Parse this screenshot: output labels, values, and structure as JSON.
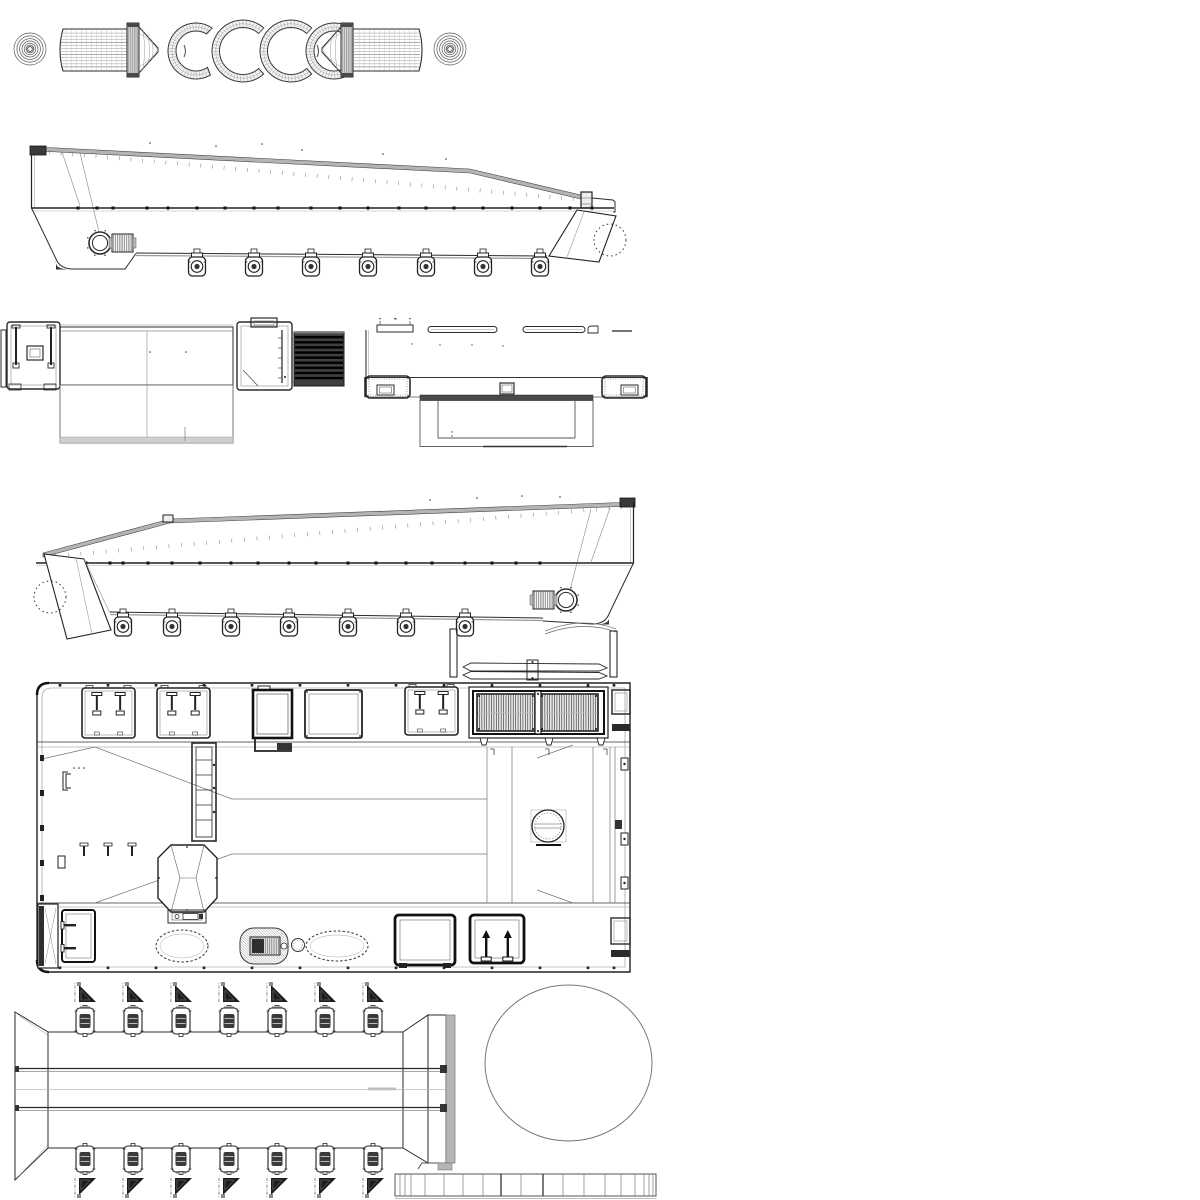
{
  "canvas": {
    "width": 1200,
    "height": 1200,
    "background": "#ffffff"
  },
  "palette": {
    "ink": "#2b2b2b",
    "ink_mid": "#555555",
    "ink_light": "#8a8a8a",
    "ink_faint": "#bdbdbd",
    "fill_dark": "#3a3a3a",
    "fill_black": "#0d0d0d",
    "deck_gray": "#b4b4b4",
    "strip_gray": "#cfcfcf",
    "paper": "#ffffff"
  },
  "drawing": {
    "title": "Landing craft hull - multi-view wireframe blueprint",
    "views": [
      {
        "id": "parts-strip",
        "label": "roller drums, end discs and fender arc segments"
      },
      {
        "id": "side-view-starboard",
        "label": "hull side elevation, bow right"
      },
      {
        "id": "end-view-bow",
        "label": "end elevation with louver block"
      },
      {
        "id": "end-view-stern",
        "label": "end elevation with outrigger pods"
      },
      {
        "id": "side-view-port",
        "label": "hull side elevation, bow left"
      },
      {
        "id": "deck-plan",
        "label": "deck plan with hatches and engine grilles"
      },
      {
        "id": "ramp-flat",
        "label": "ramp flat pattern with roller fittings"
      },
      {
        "id": "disc-part",
        "label": "large circular part"
      },
      {
        "id": "segment-strip",
        "label": "segmented edge band"
      }
    ]
  },
  "parts_strip": {
    "discs": [
      {
        "cx": 30,
        "cy": 49,
        "r": 16
      },
      {
        "cx": 450,
        "cy": 49,
        "r": 16
      }
    ],
    "arcs": [
      {
        "cx": 196,
        "cy": 51,
        "R": 28,
        "r": 20,
        "a0": 55,
        "a1": 305
      },
      {
        "cx": 243,
        "cy": 51,
        "R": 31,
        "r": 23.5,
        "a0": 48,
        "a1": 312
      },
      {
        "cx": 291,
        "cy": 51,
        "R": 31,
        "r": 23.5,
        "a0": 48,
        "a1": 312
      },
      {
        "cx": 334,
        "cy": 51,
        "R": 28,
        "r": 20,
        "a0": 55,
        "a1": 305
      }
    ],
    "hatch_step_deg": 7,
    "mesh_rows": 13,
    "mesh_cols": 13
  },
  "side_starboard": {
    "keel_y": 254,
    "roller_xs": [
      197,
      254,
      311,
      368,
      426,
      483,
      540
    ],
    "gunwale_y": 208,
    "gunwale_dot_xs": [
      78,
      97,
      113,
      147,
      168,
      197,
      225,
      254,
      278,
      311,
      340,
      368,
      399,
      426,
      454,
      483,
      512,
      540,
      570,
      592
    ],
    "deck_ticks": 46,
    "porthole": {
      "cx": 100,
      "cy": 243
    }
  },
  "side_port": {
    "keel_y": 614,
    "roller_xs": [
      123,
      172,
      231,
      289,
      348,
      406,
      465
    ],
    "gunwale_y": 563,
    "gunwale_dot_xs": [
      60,
      86,
      110,
      123,
      148,
      172,
      200,
      231,
      258,
      289,
      316,
      348,
      376,
      406,
      432,
      465,
      492,
      516,
      540
    ],
    "deck_ticks": 46,
    "porthole": {
      "cx": 566,
      "cy": 600
    }
  },
  "end_view_louver": {
    "x": 294,
    "y": 332,
    "w": 50,
    "h": 54,
    "stripes": 9
  },
  "plan": {
    "frame": {
      "x": 37,
      "y": 683,
      "w": 593,
      "h": 289
    },
    "top_hatches": [
      {
        "type": "pin-hatch",
        "x": 82,
        "y": 688,
        "w": 53,
        "h": 50
      },
      {
        "type": "pin-hatch",
        "x": 157,
        "y": 688,
        "w": 53,
        "h": 50
      },
      {
        "type": "dark-door",
        "x": 253,
        "y": 690,
        "w": 39,
        "h": 48
      },
      {
        "type": "panel",
        "x": 305,
        "y": 690,
        "w": 57,
        "h": 48
      },
      {
        "type": "pin-hatch",
        "x": 405,
        "y": 687,
        "w": 53,
        "h": 48
      }
    ],
    "grille": {
      "frame": {
        "x": 469,
        "y": 687,
        "w": 139,
        "h": 51
      },
      "panels": [
        {
          "x": 477,
          "y": 694,
          "w": 58,
          "h": 37
        },
        {
          "x": 540,
          "y": 694,
          "w": 58,
          "h": 37
        }
      ],
      "slats_per_panel": 23
    },
    "bottom_items": [
      {
        "type": "end-strip",
        "x": 38,
        "y": 904,
        "w": 20,
        "h": 64
      },
      {
        "type": "door",
        "x": 62,
        "y": 910,
        "w": 33,
        "h": 52
      },
      {
        "type": "dotted-oval",
        "cx": 182,
        "cy": 946,
        "rx": 26,
        "ry": 16
      },
      {
        "type": "hatched-oval",
        "x": 240,
        "y": 928,
        "w": 48,
        "h": 36
      },
      {
        "type": "small-circle",
        "cx": 298,
        "cy": 945,
        "r": 6.5
      },
      {
        "type": "dotted-oval",
        "cx": 337,
        "cy": 946,
        "rx": 31,
        "ry": 15
      },
      {
        "type": "dark-panel",
        "x": 395,
        "y": 915,
        "w": 60,
        "h": 50
      },
      {
        "type": "dark-panel-pins",
        "x": 470,
        "y": 915,
        "w": 54,
        "h": 48
      }
    ],
    "edge_bolt_xs": [
      60,
      108,
      156,
      204,
      252,
      300,
      348,
      396,
      444,
      492,
      540,
      588,
      614
    ],
    "left_wall_tick_ys": [
      755,
      790,
      825,
      860,
      895
    ],
    "wall_latches": [
      {
        "x": 621,
        "y": 758
      },
      {
        "x": 621,
        "y": 833
      },
      {
        "x": 621,
        "y": 877
      }
    ],
    "diag_pins_xs": [
      84,
      108,
      132
    ]
  },
  "ramp": {
    "roller_xs": [
      85,
      133,
      181,
      229,
      277,
      325,
      373
    ],
    "top_roller_y": 1008,
    "bottom_roller_y": 1146,
    "bracket_top_y": 1002,
    "bracket_bottom_y": 1178
  },
  "disc_part": {
    "cx": 568.5,
    "cy": 1063,
    "rx": 83.5,
    "ry": 78
  },
  "segment_strip": {
    "x": 395,
    "y": 1174,
    "width": 261,
    "height": 22,
    "divider_xs": [
      400,
      405,
      411,
      425,
      444,
      463,
      483,
      501,
      521,
      543,
      563,
      584,
      605,
      621,
      635,
      644,
      649,
      653
    ],
    "heavy_xs": [
      501,
      543
    ]
  }
}
